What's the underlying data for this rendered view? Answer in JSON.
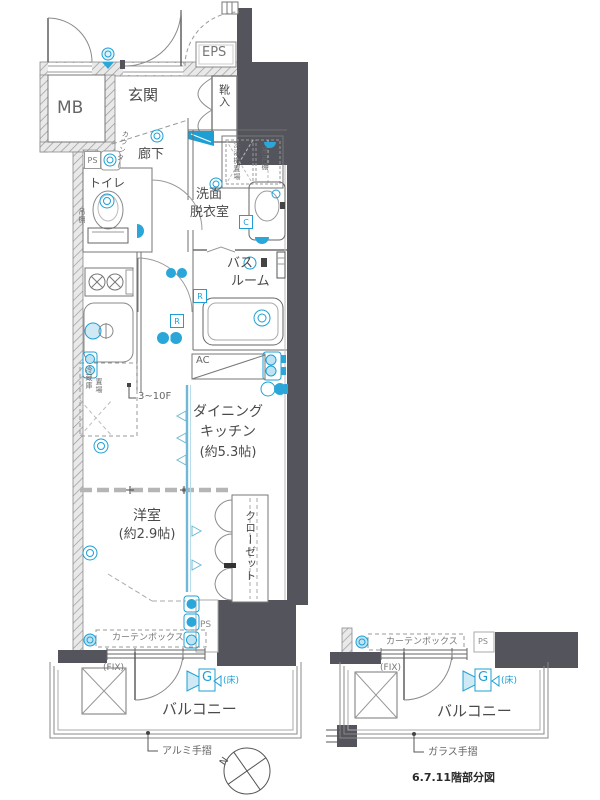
{
  "floor_plan": {
    "colors": {
      "wall_dark": "#54545c",
      "accent_teal": "#1d9fd4",
      "line_gray": "#6a6a6a",
      "hatch_gray": "#9a9a9a"
    },
    "main": {
      "rooms": {
        "meter_box": "MB",
        "entrance": "玄関",
        "eps": "EPS",
        "shoe_cabinet": "靴入",
        "corridor": "廊下",
        "toilet": "トイレ",
        "washroom_line1": "洗面",
        "washroom_line2": "脱衣室",
        "bathroom_line1": "バス",
        "bathroom_line2": "ルーム",
        "dining_kitchen_line1": "ダイニング",
        "dining_kitchen_line2": "キッチン",
        "dining_kitchen_size": "(約5.3帖)",
        "western_room": "洋室",
        "western_room_size": "(約2.9帖)",
        "closet": "クローゼット",
        "balcony": "バルコニー"
      },
      "labels": {
        "pipe_space_upper": "PS",
        "pipe_space_lower": "PS",
        "counter": "カウンター",
        "washing_machine": "洗濯機置場",
        "hanging_cupboard": "吊戸棚",
        "toilet_shelf": "吊棚",
        "fridge_line1": "冷蔵庫",
        "fridge_line2": "置場",
        "floor_range": "3~10F",
        "air_conditioner": "AC",
        "curtain_box": "カーテンボックス",
        "fix_window": "(FIX)",
        "gas_outlet": "G",
        "gas_floor": "(床)",
        "handrail": "アルミ手摺",
        "remote_badge1": "R",
        "remote_badge2": "R",
        "cold_water_badge": "C"
      }
    },
    "partial": {
      "labels": {
        "curtain_box": "カーテンボックス",
        "pipe_space": "PS",
        "fix_window": "(FIX)",
        "gas_outlet": "G",
        "gas_floor": "(床)",
        "balcony": "バルコニー",
        "handrail": "ガラス手摺",
        "caption": "6.7.11階部分図"
      }
    },
    "compass": {
      "north": "N"
    }
  }
}
